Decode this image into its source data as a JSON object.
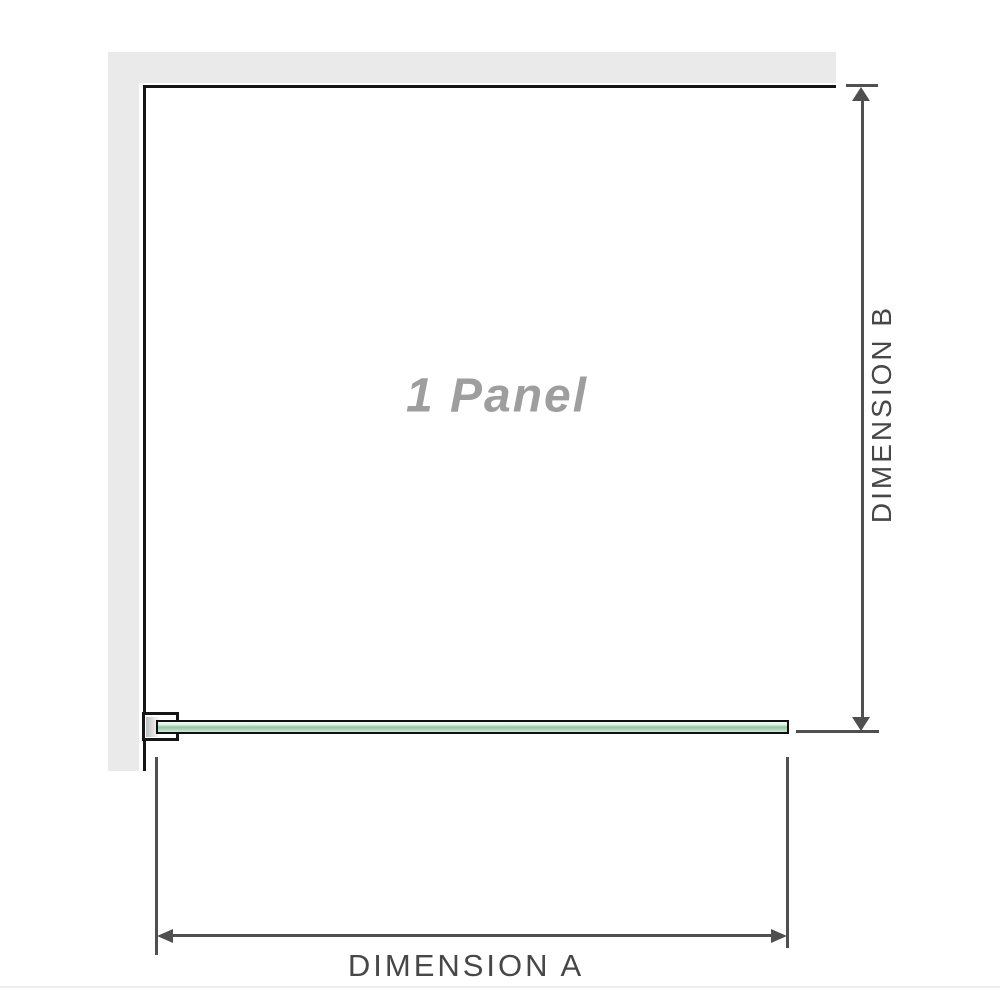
{
  "diagram": {
    "panel_label": "1 Panel",
    "dimension_a": {
      "label": "DIMENSION A"
    },
    "dimension_b": {
      "label": "DIMENSION B"
    },
    "colors": {
      "wall_fill": "#eaeaea",
      "enclosure_outline": "#151515",
      "dimension_lines": "#4f4f4f",
      "dimension_text": "#474747",
      "panel_label_text": "#9e9e9e",
      "glass_green_mid": "#90c8a5",
      "glass_green_light": "#dcefe4",
      "glass_border": "#101010",
      "bracket_channel_gray": "#bdbdbd"
    }
  }
}
